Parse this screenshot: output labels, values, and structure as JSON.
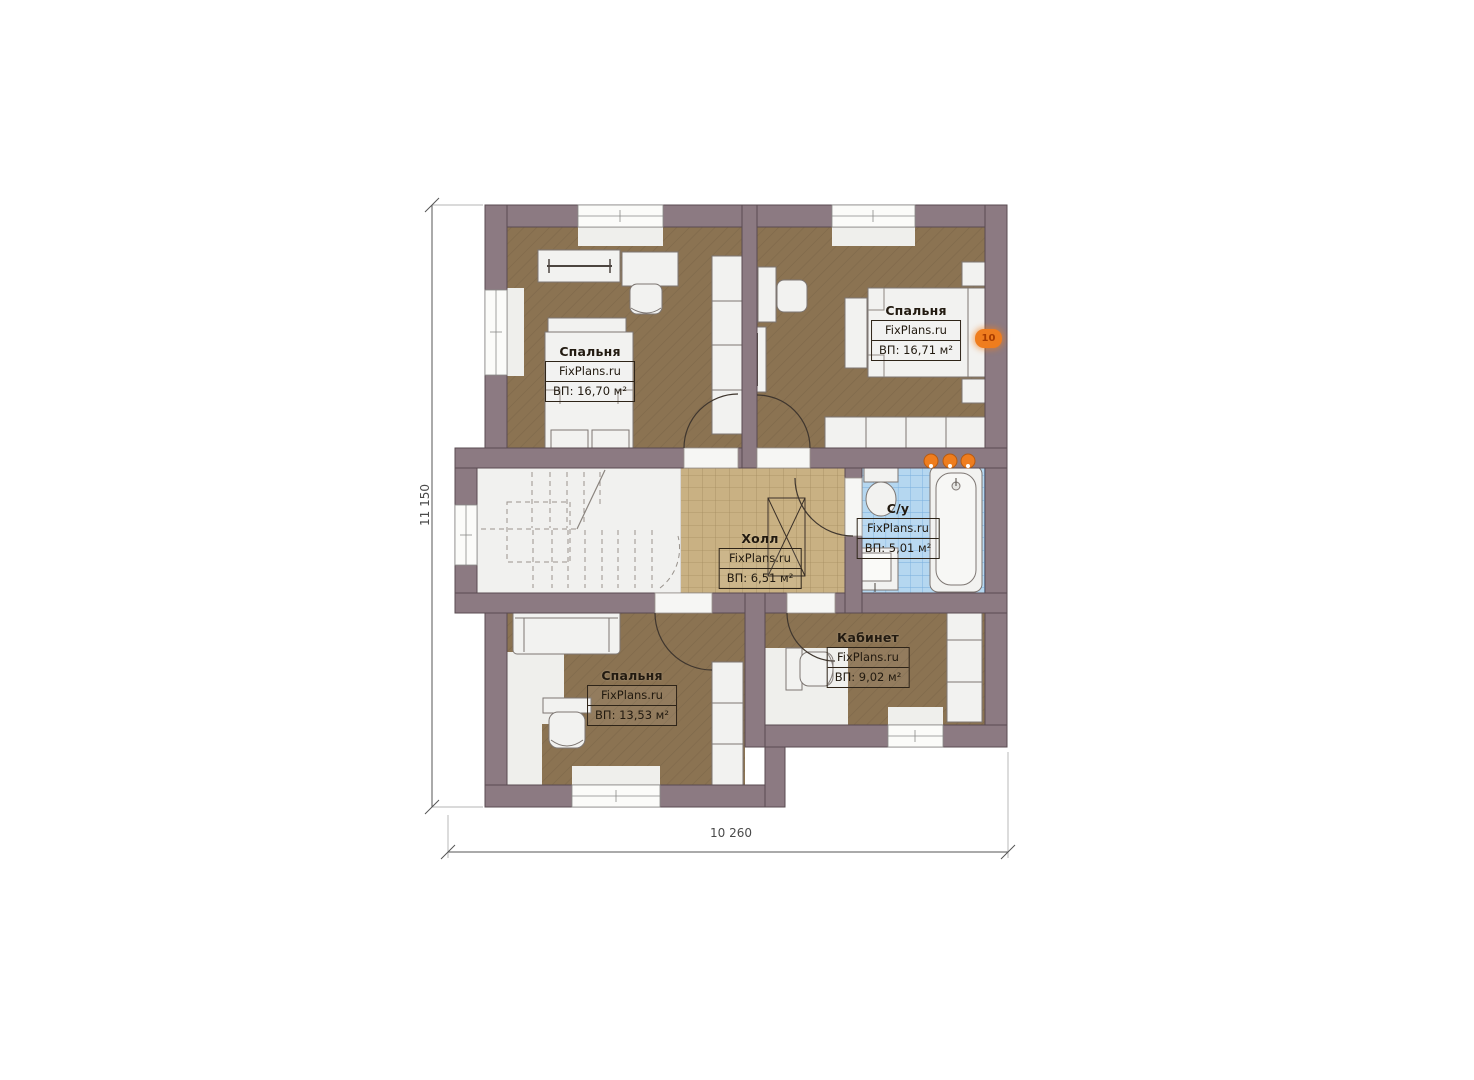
{
  "plan": {
    "dimension_height": "11 150",
    "dimension_width": "10 260",
    "marker_label": "10",
    "rooms": [
      {
        "key": "bedroom-top-left",
        "name": "Спальня",
        "brand": "FixPlans.ru",
        "area": "ВП: 16,70 м²"
      },
      {
        "key": "bedroom-top-right",
        "name": "Спальня",
        "brand": "FixPlans.ru",
        "area": "ВП: 16,71 м²"
      },
      {
        "key": "hall",
        "name": "Холл",
        "brand": "FixPlans.ru",
        "area": "ВП: 6,51 м²"
      },
      {
        "key": "bathroom",
        "name": "С/у",
        "brand": "FixPlans.ru",
        "area": "ВП: 5,01 м²"
      },
      {
        "key": "bedroom-bottom",
        "name": "Спальня",
        "brand": "FixPlans.ru",
        "area": "ВП: 13,53 м²"
      },
      {
        "key": "office",
        "name": "Кабинет",
        "brand": "FixPlans.ru",
        "area": "ВП: 9,02 м²"
      }
    ],
    "colors": {
      "wall": "#8c7a82",
      "bedroom_floor": "#8b7352",
      "hall_floor": "#c9b183",
      "bath_floor": "#b5d7f0",
      "stair_floor": "#f1f1ef",
      "furniture": "#f2f2f0",
      "accent_orange": "#e87820"
    }
  }
}
